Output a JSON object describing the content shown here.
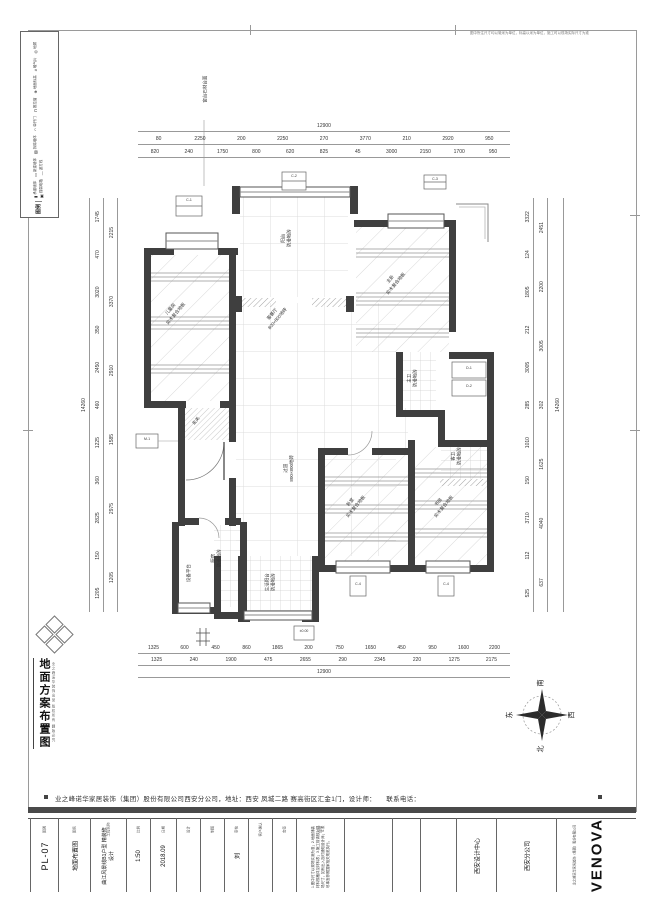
{
  "page": {
    "border_note": "图中所注尺寸均以毫米为单位，标高以米为单位，施工时以现场实际尺寸为准",
    "company_line": "业之峰诺华家居装饰（集团）股份有限公司西安分公司，地址：西安 凤城二路 赛高街区汇金1门，设计师：　　联系电话："
  },
  "legend": {
    "title": "图例",
    "items": [
      {
        "symbol": "▮",
        "label": "承重墙体"
      },
      {
        "symbol": "▭",
        "label": "新建墙体"
      },
      {
        "symbol": "▨",
        "label": "拆除墙体"
      },
      {
        "symbol": "◠",
        "label": "单开门"
      },
      {
        "symbol": "⊓",
        "label": "推拉窗"
      },
      {
        "symbol": "⊕",
        "label": "地面标高"
      },
      {
        "symbol": "#",
        "label": "暖气片"
      },
      {
        "symbol": "◎",
        "label": "地漏"
      },
      {
        "symbol": "▣",
        "label": "强弱电箱"
      },
      {
        "symbol": "—",
        "label": "波打线"
      }
    ]
  },
  "stamp": {
    "title": "地面方案布置图",
    "side_note": "业之峰诺华装饰出品 版权所有 翻版必究"
  },
  "compass": {
    "south": "南",
    "north": "北",
    "west": "西",
    "east": "东"
  },
  "plan": {
    "rooms": {
      "living": {
        "name": "客餐厅",
        "material": "800×800地砖"
      },
      "hallway": {
        "name": "过道",
        "material": "800×800地砖"
      },
      "balcony_top": {
        "name": "阳台",
        "material": "防滑地砖"
      },
      "bedroom_left": {
        "name": "儿童房",
        "material": "实木复合地板"
      },
      "bedroom_master": {
        "name": "主卧",
        "material": "实木复合地板"
      },
      "bedroom_mid": {
        "name": "卧室",
        "material": "实木复合地板"
      },
      "study": {
        "name": "书房",
        "material": "实木复合地板"
      },
      "kitchen": {
        "name": "厨房",
        "material": "防滑地砖"
      },
      "bath_master": {
        "name": "主卫",
        "material": "防滑地砖"
      },
      "bath_guest": {
        "name": "客卫",
        "material": "防滑地砖"
      },
      "entry": {
        "name": "玄关",
        "material": "拼花地砖"
      },
      "balcony_bottom": {
        "name": "生活阳台",
        "material": "防滑地砖"
      },
      "platform": {
        "name": "设备平台",
        "material": ""
      }
    },
    "tags": {
      "t1": "C-1",
      "t2": "C-2",
      "t3": "C-3",
      "t4": "D-1",
      "t5": "D-2",
      "t6": "M-1",
      "t7": "C-4",
      "t8": "C-4",
      "t9": "±0.00",
      "note_top": "窗台石材台面"
    }
  },
  "dimensions": {
    "top_total": "12900",
    "top_row1": [
      "80",
      "2250",
      "200",
      "2250",
      "270",
      "3770",
      "210",
      "2920",
      "950"
    ],
    "top_row2": [
      "820",
      "240",
      "1750",
      "800",
      "620",
      "825",
      "45",
      "3000",
      "2150",
      "1700",
      "950"
    ],
    "bottom_row1": [
      "1325",
      "600",
      "450",
      "860",
      "1865",
      "200",
      "750",
      "1650",
      "450",
      "950",
      "1600",
      "2200"
    ],
    "bottom_row2": [
      "1325",
      "240",
      "1900",
      "475",
      "2655",
      "290",
      "2345",
      "220",
      "1275",
      "2175"
    ],
    "bottom_total": "12900",
    "left_total": "14260",
    "left_row1": [
      "1205",
      "150",
      "2825",
      "360",
      "1225",
      "460",
      "2450",
      "350",
      "3020",
      "470",
      "1745"
    ],
    "left_row2": [
      "1205",
      "2975",
      "1585",
      "2910",
      "3370",
      "2215"
    ],
    "right_row1": [
      "525",
      "112",
      "3710",
      "150",
      "1010",
      "285",
      "3005",
      "212",
      "1805",
      "124",
      "3322"
    ],
    "right_row2": [
      "637",
      "4040",
      "1625",
      "302",
      "3005",
      "2200",
      "2451"
    ],
    "right_total": "14260"
  },
  "titleblock": {
    "cells": [
      {
        "label": "图别",
        "value": "PL-07"
      },
      {
        "label": "图名",
        "value": "地面布置图"
      },
      {
        "label": "工程名称",
        "value": "曲江风景线B1户型 精装修设计"
      },
      {
        "label": "比例",
        "value": "1:50"
      },
      {
        "label": "日期",
        "value": "2018.09"
      },
      {
        "label": "设计",
        "value": ""
      },
      {
        "label": "制图",
        "value": ""
      },
      {
        "label": "审核",
        "value": "刘"
      },
      {
        "label": "客户确认",
        "value": ""
      },
      {
        "label": "会签",
        "value": ""
      },
      {
        "label": "说明",
        "value": "1.图中尺寸以现场实测为准；2.地面铺装材料规格详见材料表；3.施工前请核对现场尺寸，如有出入及时通知设计师；4.未尽事宜参照国家相关规范执行。"
      },
      {
        "label": "",
        "value": ""
      },
      {
        "label": "",
        "value": ""
      },
      {
        "label": "",
        "value": ""
      },
      {
        "label": "",
        "value": "西安设计中心"
      },
      {
        "label": "",
        "value": "西安分公司"
      }
    ],
    "logo": "VENOVA",
    "logo_sub": "业之峰诺华家居装饰（集团）股份有限公司"
  }
}
